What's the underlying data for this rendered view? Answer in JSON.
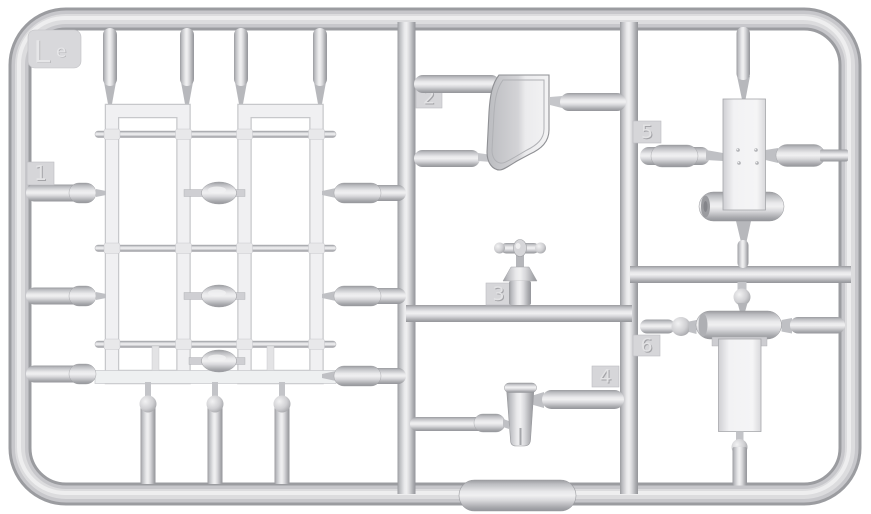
{
  "sprue": {
    "corner_label": {
      "main": "L",
      "sub": "e"
    },
    "part_tags": [
      {
        "label": "1"
      },
      {
        "label": "2"
      },
      {
        "label": "3"
      },
      {
        "label": "4"
      },
      {
        "label": "5"
      },
      {
        "label": "6"
      }
    ],
    "colors": {
      "background": "#ffffff",
      "plastic_highlight": "#efeff0",
      "plastic_mid": "#cbcbcf",
      "plastic_shadow": "#97989c",
      "molded_part_white": "#f2f2f3",
      "tag_face": "#d6d6d9"
    }
  }
}
